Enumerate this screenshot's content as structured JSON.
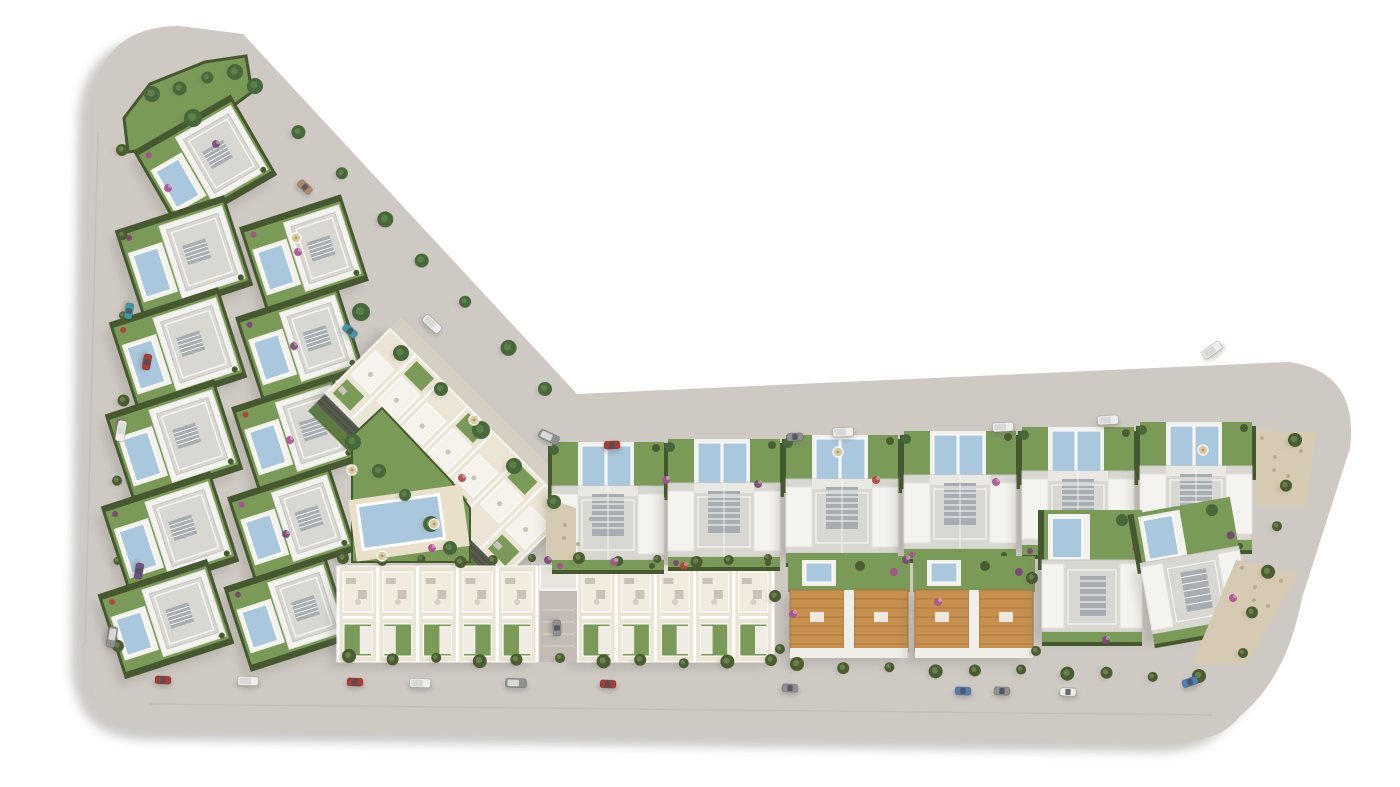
{
  "meta": {
    "canvas_width": 1400,
    "canvas_height": 787,
    "view": "aerial-site-plan"
  },
  "palette": {
    "background": "#ffffff",
    "road": "#cfc9c3",
    "road_dark": "#c2bcb6",
    "parcel_shadow": "#8d8781",
    "grass": "#7a9a57",
    "grass_dark": "#5d7a40",
    "hedge": "#45582f",
    "tree": "#4a5c32",
    "tree_light": "#66824a",
    "palm": "#47683a",
    "palm_light": "#5d8048",
    "wall_white": "#f4f3ef",
    "wall_edge": "#e2e0db",
    "roof_gray": "#d8d7d2",
    "roof_edge": "#c6c5c0",
    "roof_band": "#eae8e3",
    "parapet": "#f6f5f1",
    "louvre": "#a7adb0",
    "cream": "#ece4d4",
    "cream_light": "#f2ecdf",
    "cream_deep": "#e9dfcb",
    "pool": "#a9c8dd",
    "pool_deck": "#f3f1ec",
    "terracotta": "#c7904f",
    "terracotta_dark": "#a5763c",
    "gabion_wall": "#565b4e",
    "gabion_line": "#454a3f",
    "gravel": "#d6cab2",
    "gravel_dot": "#b7ab92",
    "walkway": "#d6d0c4",
    "furniture": "#c9c3b8",
    "shadow": "#6b665f",
    "umbrella": "#dbc9a0",
    "lane": "#c2bcb4",
    "canopy": "#e9e6df"
  },
  "car_colors": {
    "red": "#a83c36",
    "teal": "#3f98a5",
    "white": "#ededeb",
    "gray": "#8f9093",
    "blue": "#4f7fb3",
    "purple": "#6f4f86",
    "tan": "#b08968",
    "window": "#4a525a",
    "van_roof": "#d8d8d6"
  },
  "shrub_colors": [
    "#a8538f",
    "#7c4a74",
    "#b0473f"
  ],
  "parcel": {
    "path": "M 92,118 C 92,52 128,26 180,26 L 243,34 L 577,394 L 1288,362 C 1336,368 1356,398 1350,448 L 1302,598 C 1292,650 1272,690 1240,716 C 1225,736 1200,742 1170,742 L 160,730 C 105,728 88,700 85,655 Z",
    "shadow_dx": -14,
    "shadow_dy": 10
  },
  "curbs": [
    "M 150,704 L 1212,715",
    "M 98,132 L 85,645"
  ],
  "top_garden_points": "124,118 150,84 205,62 246,56 252,92 214,120 160,148 128,152",
  "communal": {
    "grass_points": "352,436 382,408 452,482 470,508 470,562 352,562",
    "deck": [
      352,
      492,
      114,
      62,
      -8
    ],
    "pool": [
      360,
      500,
      82,
      44,
      -8
    ]
  },
  "apartment": {
    "cx": 448,
    "cy": 452,
    "rot": 45,
    "len": 256,
    "wid": 92,
    "cols": 7
  },
  "left_villas": [
    [
      150,
      118,
      110,
      90,
      -30
    ],
    [
      128,
      212,
      112,
      92,
      -18
    ],
    [
      122,
      304,
      112,
      92,
      -18
    ],
    [
      118,
      396,
      112,
      92,
      -18
    ],
    [
      114,
      488,
      112,
      92,
      -18
    ],
    [
      110,
      576,
      112,
      86,
      -18
    ],
    [
      252,
      210,
      104,
      88,
      -18
    ],
    [
      248,
      300,
      104,
      88,
      -18
    ],
    [
      244,
      390,
      104,
      88,
      -18
    ],
    [
      240,
      480,
      104,
      88,
      -18
    ],
    [
      236,
      570,
      104,
      86,
      -18
    ]
  ],
  "big_villas": [
    [
      552,
      486
    ],
    [
      668,
      483
    ],
    [
      786,
      479
    ],
    [
      904,
      475
    ],
    [
      1022,
      471
    ],
    [
      1140,
      466
    ]
  ],
  "orange_duplexes": [
    [
      790,
      590
    ],
    [
      915,
      590
    ]
  ],
  "right_villas": [
    [
      1042,
      560,
      0
    ],
    [
      1148,
      554,
      -10
    ]
  ],
  "townhouse_blocks": [
    [
      338,
      566,
      199,
      5
    ],
    [
      577,
      566,
      196,
      5
    ]
  ],
  "entrance_lane": [
    540,
    566,
    37,
    96
  ],
  "gravel_areas": [
    "1256,430 1316,432 1306,506 1256,506",
    "1236,560 1298,574 1246,664 1192,664",
    "546,498 576,508 576,560 546,560"
  ],
  "tree_rows": [
    [
      352,
      658,
      768,
      662,
      11,
      7,
      "s"
    ],
    [
      800,
      666,
      1198,
      676,
      10,
      7,
      "s"
    ],
    [
      125,
      152,
      116,
      645,
      7,
      6,
      "s"
    ],
    [
      258,
      88,
      548,
      390,
      8,
      8,
      "p"
    ],
    [
      364,
      314,
      554,
      504,
      6,
      9,
      "p"
    ],
    [
      346,
      560,
      532,
      560,
      6,
      6,
      "s"
    ],
    [
      582,
      560,
      768,
      560,
      6,
      6,
      "s"
    ],
    [
      1298,
      442,
      1243,
      655,
      6,
      7,
      "s"
    ],
    [
      155,
      96,
      232,
      70,
      4,
      8,
      "p"
    ],
    [
      356,
      444,
      452,
      548,
      5,
      8,
      "p"
    ],
    [
      778,
      598,
      781,
      648,
      2,
      6,
      "s"
    ],
    [
      1035,
      580,
      1037,
      650,
      2,
      6,
      "s"
    ],
    [
      196,
      120,
      196,
      120,
      1,
      9,
      "p"
    ]
  ],
  "shrubs": [
    [
      168,
      188,
      0
    ],
    [
      216,
      144,
      1
    ],
    [
      298,
      252,
      0
    ],
    [
      294,
      346,
      1
    ],
    [
      290,
      440,
      0
    ],
    [
      286,
      534,
      1
    ],
    [
      462,
      478,
      2
    ],
    [
      666,
      480,
      0
    ],
    [
      906,
      560,
      1
    ],
    [
      938,
      602,
      0
    ],
    [
      793,
      614,
      0
    ],
    [
      1106,
      640,
      1
    ],
    [
      684,
      566,
      2
    ],
    [
      1233,
      598,
      0
    ],
    [
      548,
      560,
      1
    ],
    [
      432,
      548,
      0
    ],
    [
      614,
      562,
      0
    ],
    [
      876,
      480,
      2
    ],
    [
      996,
      482,
      0
    ],
    [
      758,
      484,
      1
    ]
  ],
  "umbrellas": [
    [
      352,
      470
    ],
    [
      434,
      524
    ],
    [
      382,
      556
    ],
    [
      838,
      452
    ],
    [
      1203,
      450
    ],
    [
      296,
      238
    ],
    [
      474,
      420
    ]
  ],
  "cars": [
    [
      129,
      311,
      100,
      "teal",
      0
    ],
    [
      147,
      362,
      100,
      "red",
      0
    ],
    [
      121,
      431,
      100,
      "white",
      1
    ],
    [
      139,
      571,
      100,
      "purple",
      0
    ],
    [
      112,
      637,
      100,
      "gray",
      1
    ],
    [
      305,
      187,
      43,
      "tan",
      0
    ],
    [
      350,
      331,
      43,
      "teal",
      0
    ],
    [
      432,
      324,
      43,
      "white",
      1
    ],
    [
      549,
      437,
      25,
      "gray",
      1
    ],
    [
      612,
      445,
      -3,
      "red",
      0
    ],
    [
      795,
      437,
      -3,
      "gray",
      0
    ],
    [
      843,
      432,
      -3,
      "white",
      1
    ],
    [
      1003,
      427,
      -3,
      "white",
      1
    ],
    [
      1108,
      420,
      -3,
      "white",
      1
    ],
    [
      1212,
      350,
      -35,
      "white",
      1
    ],
    [
      163,
      680,
      2,
      "red",
      0
    ],
    [
      248,
      681,
      2,
      "white",
      1
    ],
    [
      355,
      682,
      2,
      "red",
      0
    ],
    [
      420,
      683,
      2,
      "white",
      1
    ],
    [
      516,
      683,
      2,
      "gray",
      1
    ],
    [
      608,
      684,
      2,
      "red",
      0
    ],
    [
      790,
      688,
      2,
      "gray",
      0
    ],
    [
      963,
      691,
      2,
      "blue",
      0
    ],
    [
      1002,
      691,
      2,
      "gray",
      0
    ],
    [
      1068,
      692,
      2,
      "white",
      0
    ],
    [
      1190,
      682,
      -20,
      "blue",
      0
    ],
    [
      557,
      628,
      88,
      "gray",
      0
    ]
  ]
}
